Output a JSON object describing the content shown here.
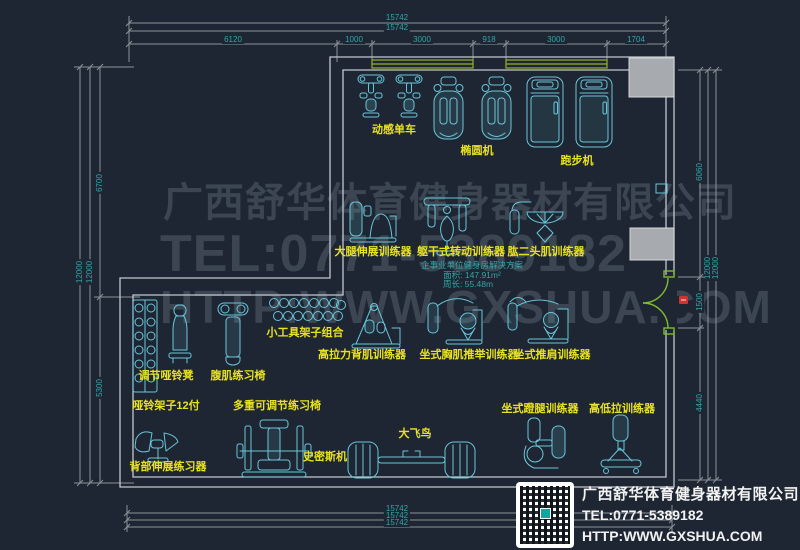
{
  "watermark": {
    "line1": "广西舒华体育健身器材有限公司",
    "line2": "TEL:0771-5389182",
    "line3": "HTTP:WWW.GXSHUA.COM"
  },
  "company_card": {
    "name": "广西舒华体育健身器材有限公司",
    "tel": "TEL:0771-5389182",
    "url": "HTTP:WWW.GXSHUA.COM"
  },
  "info_block": {
    "title": "企事业单位健身房解决方案",
    "area": "面积: 147.91m²",
    "perimeter": "周长: 55.48m"
  },
  "equipment": {
    "spin_bike": "动感单车",
    "elliptical": "椭圆机",
    "treadmill": "跑步机",
    "leg_extension": "大腿伸展训练器",
    "torso_rotation": "躯干式转动训练器",
    "biceps_trainer": "肱二头肌训练器",
    "tool_rack": "小工具架子组合",
    "lat_pulldown": "高拉力背肌训练器",
    "chest_press": "坐式胸肌推举训练器",
    "shoulder_press": "坐式推肩训练器",
    "adj_dumbbell_bench": "调节哑铃凳",
    "ab_bench": "腹肌练习椅",
    "dumbbell_rack": "哑铃架子12付",
    "multi_adj_bench": "多重可调节练习椅",
    "back_extension": "背部伸展练习器",
    "smith_machine": "史密斯机",
    "cable_crossover": "大飞鸟",
    "leg_press": "坐式蹬腿训练器",
    "high_low_pull": "高低拉训练器"
  },
  "dims": {
    "top_total_a": "15742",
    "top_total_b": "15742",
    "top_segments": [
      "6120",
      "1000",
      "3000",
      "918",
      "3000",
      "1704"
    ],
    "bottom_totals": [
      "15742",
      "15742",
      "15742"
    ],
    "left": {
      "upper": "6700",
      "total_a": "12000",
      "total_b": "12000",
      "lower": "5300"
    },
    "right": {
      "upper": "6060",
      "total_a": "12000",
      "total_b": "12000",
      "door": "1500",
      "lower": "4440"
    }
  },
  "colors": {
    "background": "#1e2633",
    "equipment_line": "#69c6da",
    "label_yellow": "#e9e21f",
    "dimension_text": "#2fa7a7",
    "dimension_line": "#8b9198",
    "wall": "#c3c8cd",
    "window_green": "#93b32b",
    "door_green": "#7fbc2e",
    "column_gray": "#a7abaf",
    "watermark_gray": "#3c4653",
    "company_text": "#f2f2f2"
  }
}
